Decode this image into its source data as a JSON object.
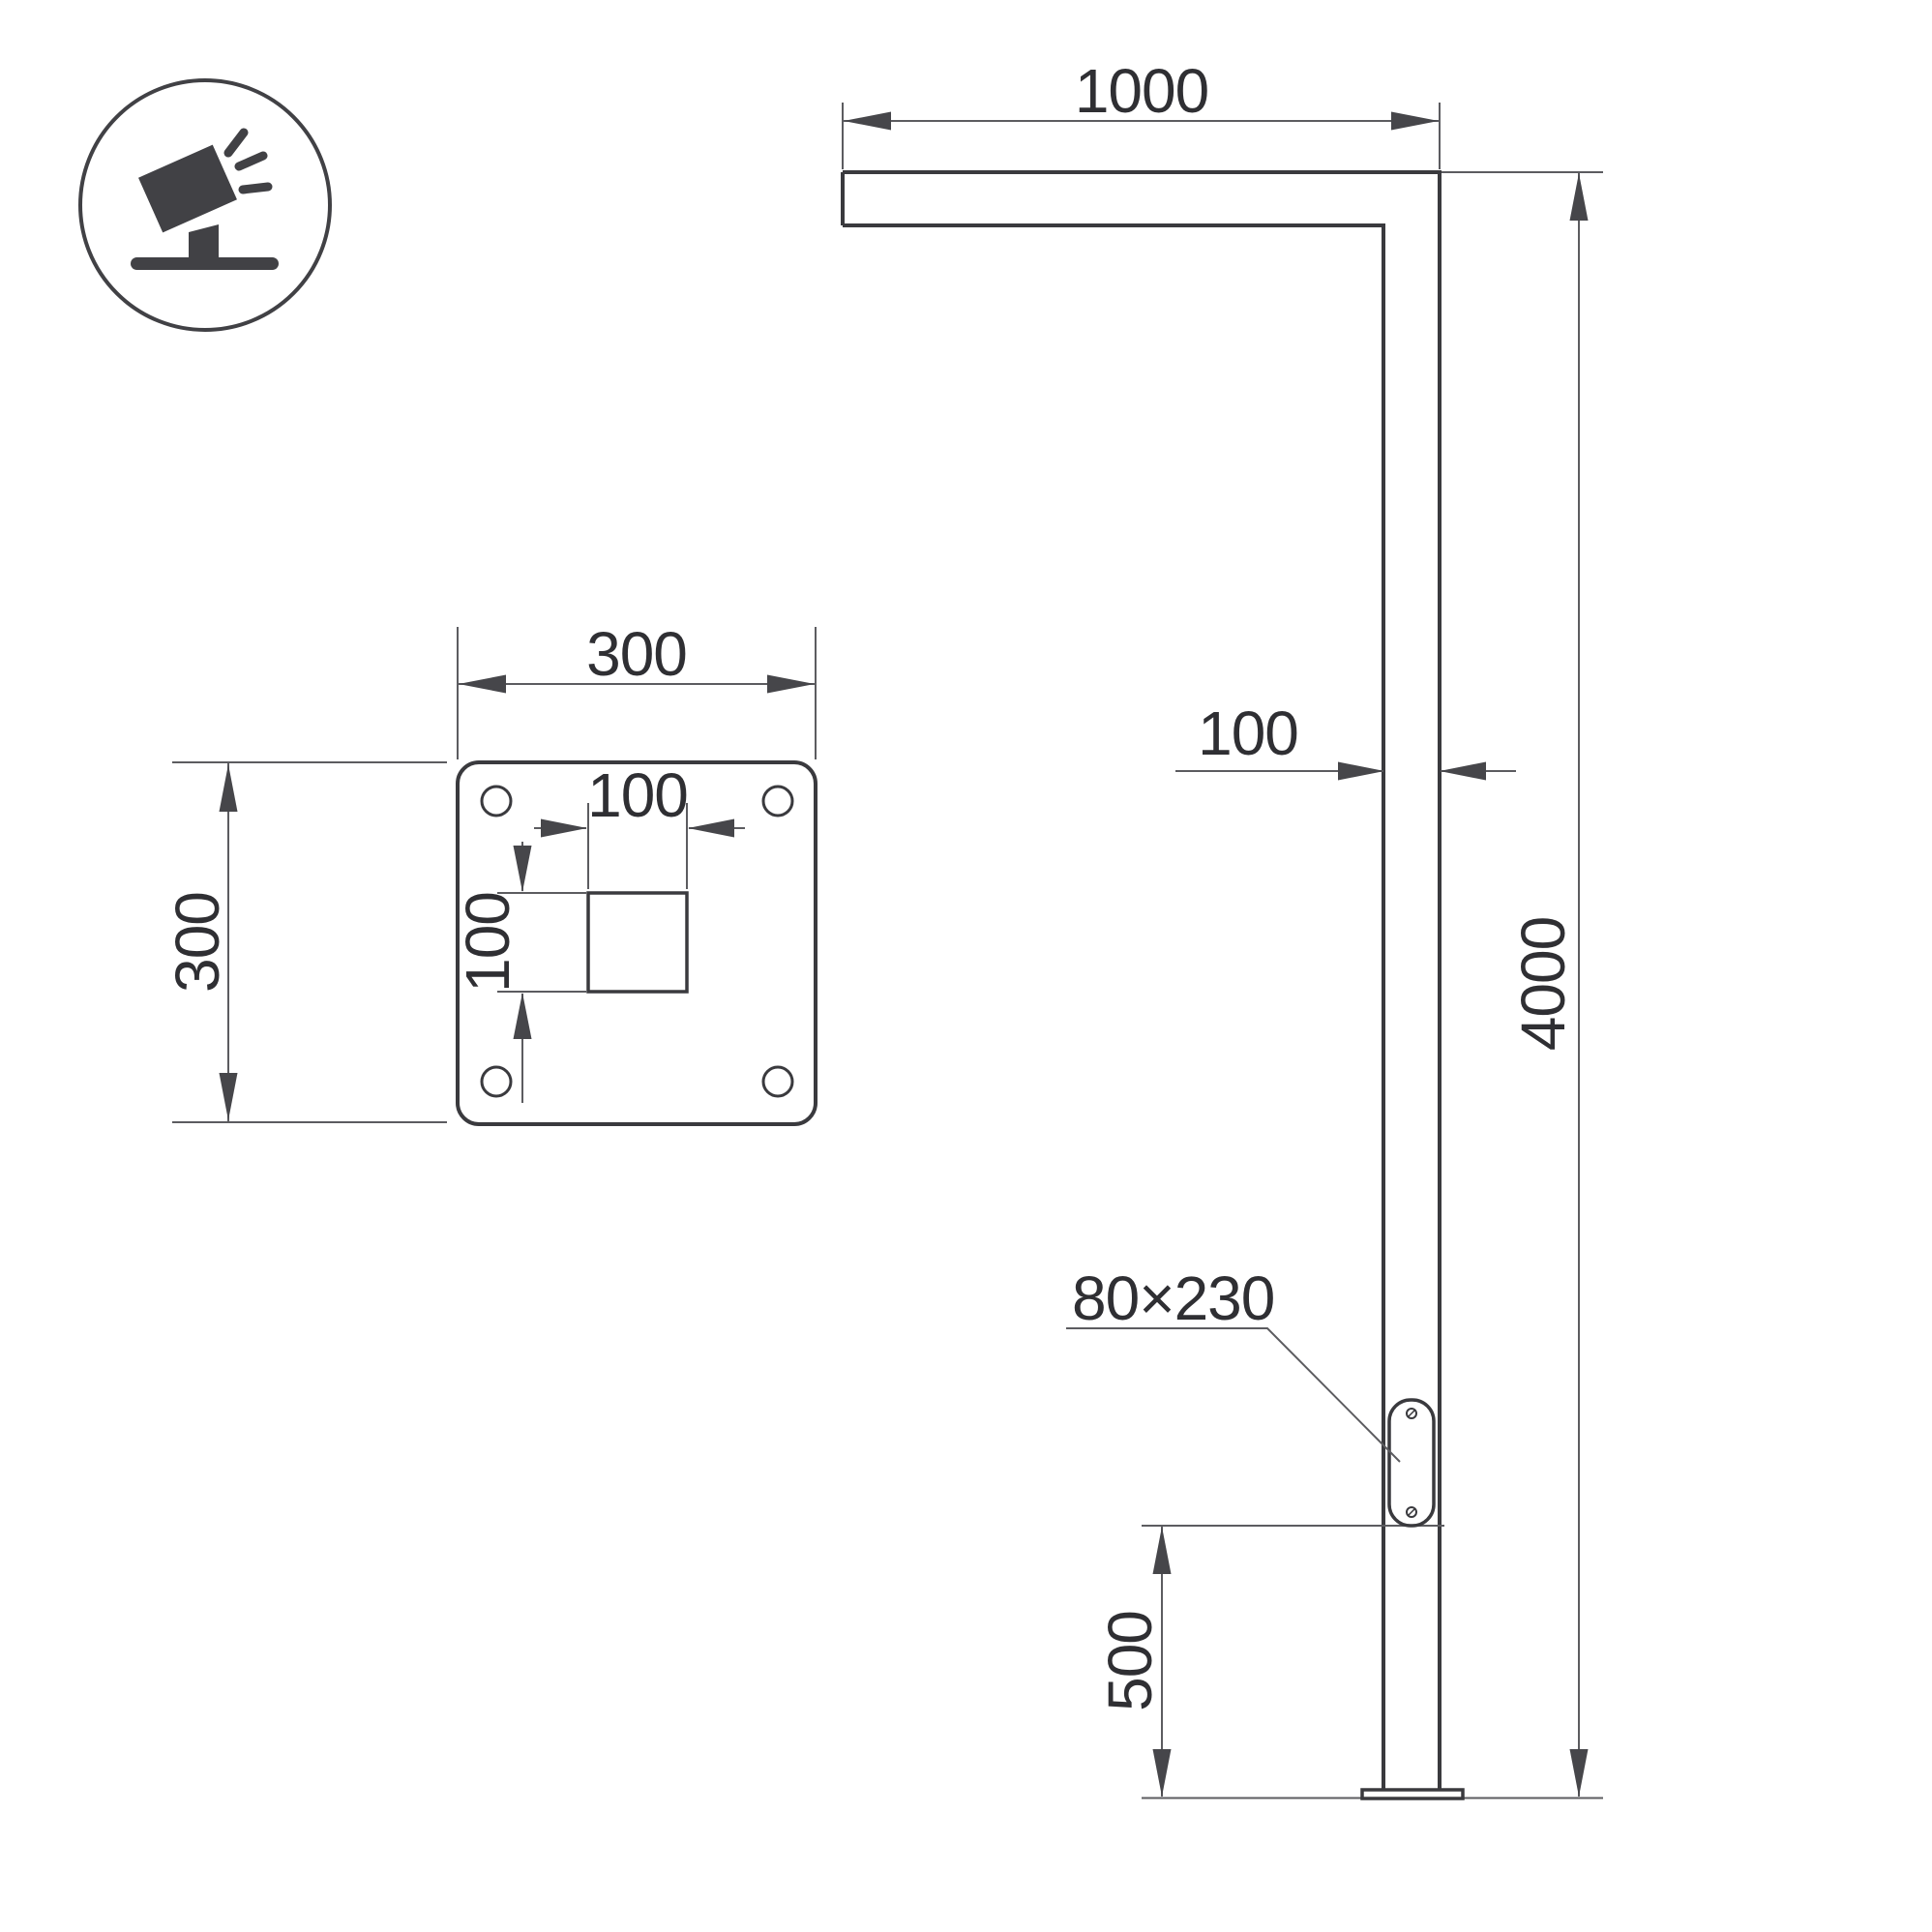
{
  "colors": {
    "background": "#ffffff",
    "outline": "#3a3a3e",
    "dim": "#5c5c60",
    "arrow": "#46464a",
    "text": "#2f2f33",
    "icon": "#414145"
  },
  "icon": {
    "name": "tilted-floodlight-on-ground"
  },
  "pole_view": {
    "dims": {
      "arm_length": "1000",
      "pole_width": "100",
      "total_height": "4000",
      "service_door_size": "80×230",
      "door_height_from_base": "500"
    }
  },
  "plate_view": {
    "dims": {
      "plate_width": "300",
      "plate_height": "300",
      "cutout_width": "100",
      "cutout_height": "100"
    }
  }
}
